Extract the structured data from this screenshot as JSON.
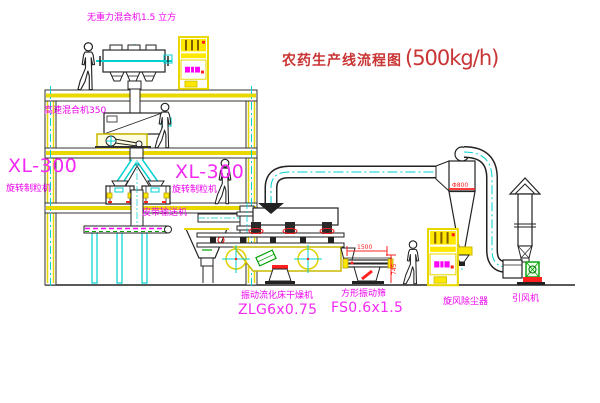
{
  "title": {
    "name": "农药生产线流程图",
    "capacity": "(500kg/h)"
  },
  "labels": {
    "gravity_mixer": "无重力混合机1.5 立方",
    "high_speed_mixer": "高速混合机350",
    "granulator_left": {
      "model": "XL-300",
      "name": "旋转制粒机"
    },
    "granulator_mid": {
      "model": "XL-300",
      "name": "旋转制粒机"
    },
    "belt_conveyor": "皮带输送机",
    "fluid_bed_dryer": {
      "name": "振动流化床干燥机",
      "model": "ZLG6x0.75"
    },
    "square_sieve": {
      "name": "方形振动筛",
      "model": "FS0.6x1.5"
    },
    "cyclone": "旋风除尘器",
    "fan": "引风机"
  },
  "dimensions": {
    "sieve_length": "1500",
    "sieve_height": "745",
    "cyclone_dia": "Φ800"
  },
  "colors": {
    "label_magenta": "#ee00ee",
    "title_red": "#c93434",
    "structure_yellow": "#e8d800",
    "centerline_cyan": "#00d0d0",
    "detail_red": "#ff2020",
    "detail_green": "#00a000",
    "line_black": "#222222"
  }
}
